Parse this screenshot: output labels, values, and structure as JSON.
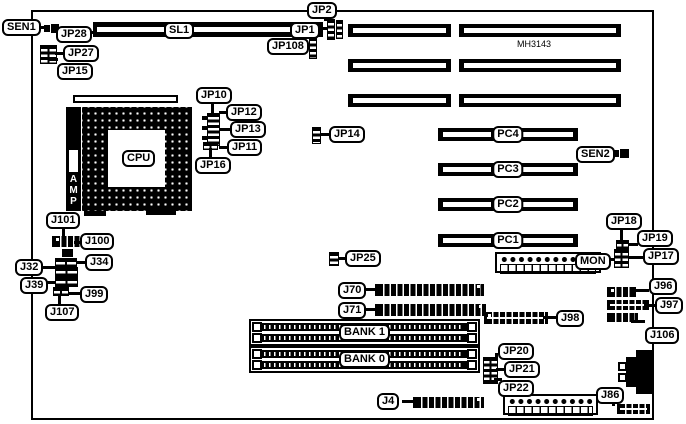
{
  "board": {
    "model": "MH3143"
  },
  "callouts": {
    "sen1": "SEN1",
    "jp28": "JP28",
    "jp27": "JP27",
    "jp15": "JP15",
    "sl1": "SL1",
    "jp1": "JP1",
    "jp2": "JP2",
    "jp108": "JP108",
    "jp10": "JP10",
    "jp12": "JP12",
    "jp13": "JP13",
    "jp11": "JP11",
    "jp16": "JP16",
    "cpu": "CPU",
    "amp": "AMP",
    "jp14": "JP14",
    "pc4": "PC4",
    "pc3": "PC3",
    "pc2": "PC2",
    "pc1": "PC1",
    "sen2": "SEN2",
    "j101": "J101",
    "j100": "J100",
    "j34": "J34",
    "j32": "J32",
    "j39": "J39",
    "j99": "J99",
    "j107": "J107",
    "jp25": "JP25",
    "mon": "MON",
    "jp18": "JP18",
    "jp19": "JP19",
    "jp17": "JP17",
    "j96": "J96",
    "j97": "J97",
    "j106": "J106",
    "j70": "J70",
    "j71": "J71",
    "bank1": "BANK 1",
    "bank0": "BANK 0",
    "j98": "J98",
    "jp20": "JP20",
    "jp21": "JP21",
    "jp22": "JP22",
    "j86": "J86",
    "j4": "J4"
  }
}
